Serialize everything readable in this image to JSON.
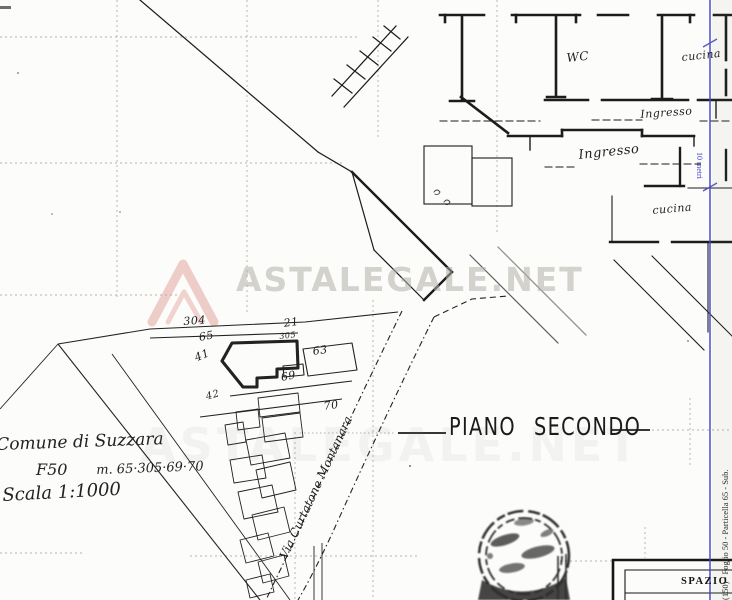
{
  "watermark": {
    "brand": "ASTALEGALE.NET",
    "icon": "mountain-peak-logo-icon",
    "logo_color": "#dc8d85"
  },
  "plan": {
    "title": "PIANO SECONDO",
    "rooms": {
      "wc": "WC",
      "kitchen_top": "cucina",
      "entrance_upper": "Ingresso",
      "entrance_lower": "Ingresso",
      "kitchen_lower": "cucina"
    }
  },
  "scale_bar": {
    "label": "10 metri",
    "color": "#4646c8"
  },
  "cadastral_map": {
    "parcel_numbers": {
      "n304": "304",
      "n21": "21",
      "n65": "65",
      "n305": "305",
      "n63": "63",
      "n41": "41",
      "n69": "69",
      "n42": "42",
      "n70": "70"
    },
    "street_name": "Via Curtatone Montanara"
  },
  "handwritten_notes": {
    "municipality": "Comune di Suzzara",
    "sheet": "F50",
    "parcel_list": "m. 65·305·69·70",
    "scale": "Scala 1:1000"
  },
  "margin_reference": "(150) - Foglio 50 - Particella 65 - Sub.",
  "footer_block_label": "SPAZIO RI",
  "stamp": {
    "icon": "round-ink-stamp",
    "legible": "no"
  },
  "colors": {
    "ink": "#1c1c1c",
    "paper": "#fcfcfa",
    "blue_line": "#4646c8"
  }
}
